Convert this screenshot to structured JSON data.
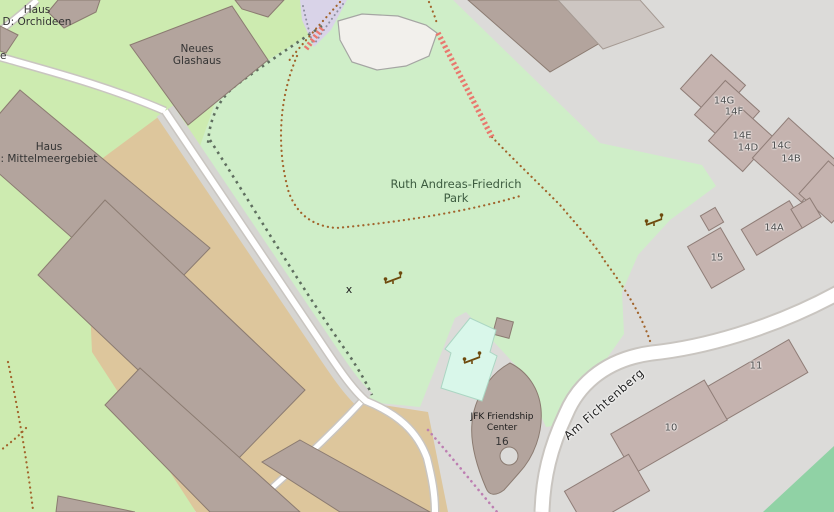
{
  "map": {
    "park_label": {
      "line1": "Ruth Andreas-Friedrich",
      "line2": "Park"
    },
    "street_label": "Am Fichtenberg",
    "poi_labels": {
      "haus_d": {
        "line1": "Haus",
        "line2": "D: Orchideen"
      },
      "neues_glashaus": {
        "line1": "Neues",
        "line2": "Glashaus"
      },
      "haus_mittelmeer": {
        "line1": "Haus",
        "line2": ": Mittelmeergebiet"
      },
      "jfk": {
        "line1": "JFK Friendship",
        "line2": "Center",
        "number": "16"
      },
      "edge_fragment": "e",
      "x_marker": "x"
    },
    "house_numbers": [
      {
        "label": "14G"
      },
      {
        "label": "14F"
      },
      {
        "label": "14E"
      },
      {
        "label": "14D"
      },
      {
        "label": "14C"
      },
      {
        "label": "14B"
      },
      {
        "label": "14A"
      },
      {
        "label": "15"
      },
      {
        "label": "11"
      },
      {
        "label": "10"
      }
    ],
    "icons": [
      "seesaw-icon",
      "seesaw-icon",
      "seesaw-icon"
    ],
    "colors": {
      "urban_background": "#dcdbd9",
      "park_green": "#cfeec8",
      "grass_green": "#cdebb0",
      "building": "#b3a49d",
      "building_residential": "#c5b3af",
      "road_fill": "#ffffff",
      "road_casing": "#c9c5c0",
      "farmland_tan": "#ddc69c",
      "playground_cyan": "#d9f7ea",
      "pitch_green": "#90d2a5",
      "steps_salmon": "#e9786e",
      "footway_dots": "#bd7fb2",
      "path_dots": "#a1642c",
      "basin_white": "#f2f0ec",
      "purple_area": "#d9d3e8",
      "hedge_dots": "#5f6e5f"
    }
  }
}
